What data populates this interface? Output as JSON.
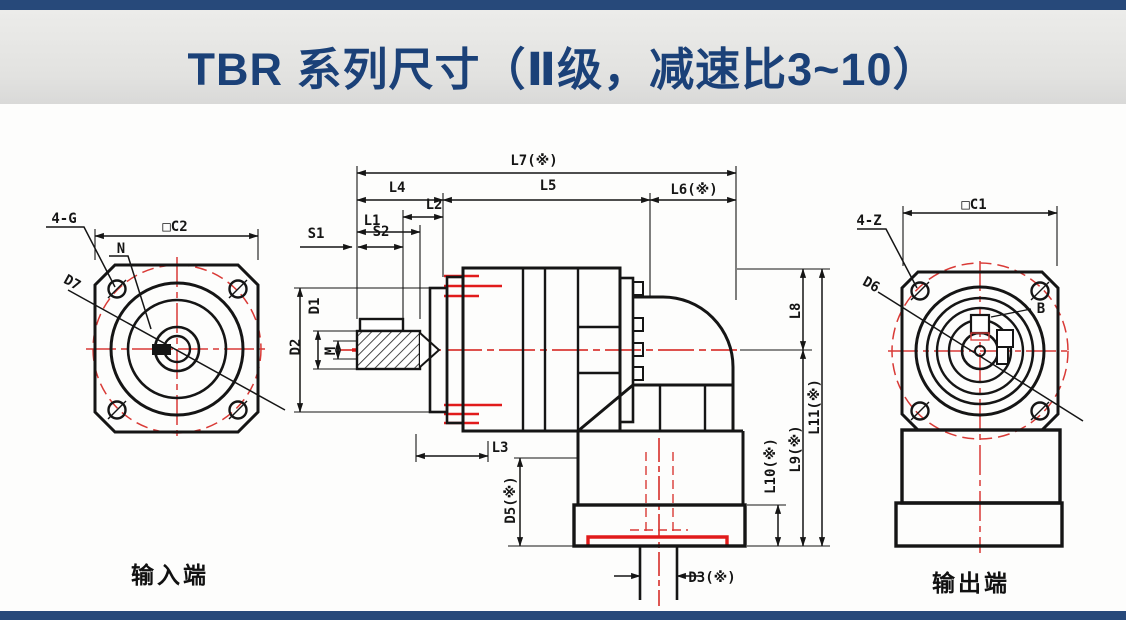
{
  "header": {
    "title": "TBR 系列尺寸（Ⅱ级，减速比3~10）"
  },
  "colors": {
    "accent_bar_navy": "#27497a",
    "title_text_navy": "#1b4178",
    "banner_gray": "#e4e4e2",
    "drawing_line_black": "#151515",
    "centerline_red": "#d93a36",
    "highlight_red": "#e11b1b"
  },
  "input_view": {
    "caption": "输入端",
    "labels": {
      "bolt_holes": "4-G",
      "square_size": "□C2",
      "pilot_diameter": "N",
      "bolt_circle": "D7"
    }
  },
  "side_view": {
    "labels": {
      "l7": "L7(※)",
      "l4": "L4",
      "l5": "L5",
      "l6": "L6(※)",
      "l2": "L2",
      "l1": "L1",
      "s1": "S1",
      "s2": "S2",
      "d1": "D1",
      "d2": "D2",
      "m": "M",
      "l3": "L3",
      "d5": "D5(※)",
      "d3": "D3(※)",
      "l8": "L8",
      "l9": "L9(※)",
      "l10": "L10(※)",
      "l11": "L11(※)"
    }
  },
  "output_view": {
    "caption": "输出端",
    "labels": {
      "bolt_holes": "4-Z",
      "square_size": "□C1",
      "bolt_circle": "D6",
      "keyway_width": "B"
    }
  }
}
